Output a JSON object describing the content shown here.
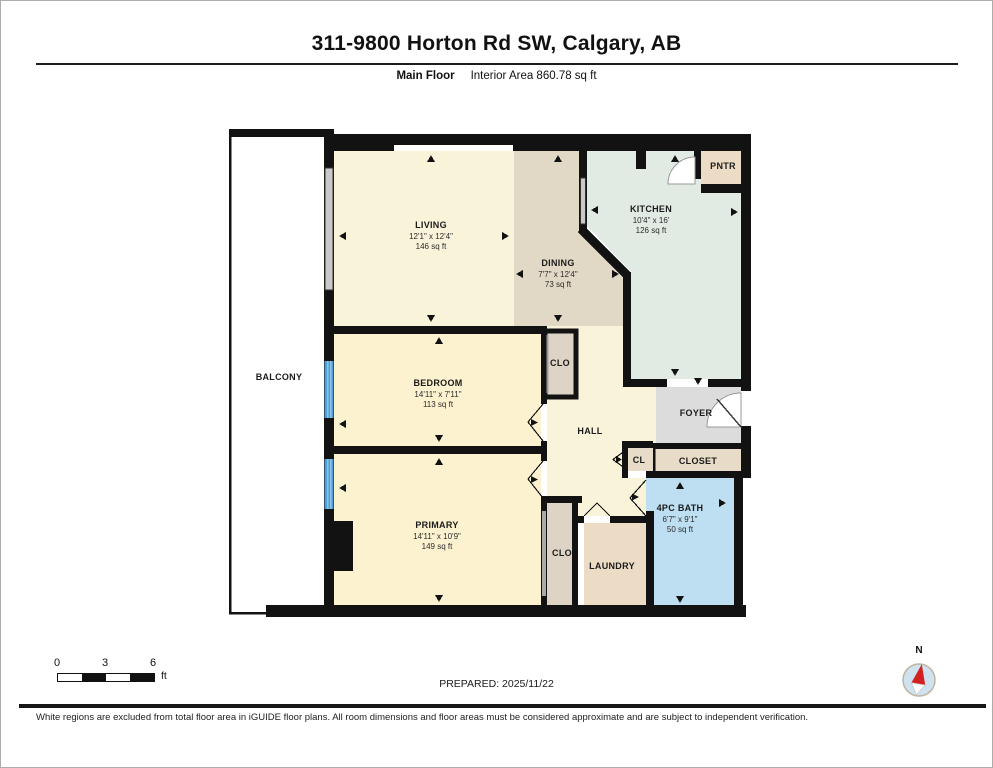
{
  "header": {
    "title": "311-9800 Horton Rd SW, Calgary, AB",
    "floor_label": "Main Floor",
    "area_label": "Interior Area 860.78 sq ft"
  },
  "rooms": {
    "balcony": {
      "name": "BALCONY"
    },
    "living": {
      "name": "LIVING",
      "dim": "12'1\" x 12'4\"",
      "area": "146 sq ft"
    },
    "dining": {
      "name": "DINING",
      "dim": "7'7\" x 12'4\"",
      "area": "73 sq ft"
    },
    "kitchen": {
      "name": "KITCHEN",
      "dim": "10'4\" x 16'",
      "area": "126 sq ft"
    },
    "pantry": {
      "name": "PNTR"
    },
    "bedroom": {
      "name": "BEDROOM",
      "dim": "14'11\" x 7'11\"",
      "area": "113 sq ft"
    },
    "bedroom_closet": {
      "name": "CLO"
    },
    "hall": {
      "name": "HALL"
    },
    "foyer": {
      "name": "FOYER"
    },
    "closet_small": {
      "name": "CL"
    },
    "closet": {
      "name": "CLOSET"
    },
    "primary": {
      "name": "PRIMARY",
      "dim": "14'11\" x 10'9\"",
      "area": "149 sq ft"
    },
    "primary_closet": {
      "name": "CLO"
    },
    "laundry": {
      "name": "LAUNDRY"
    },
    "bath": {
      "name": "4PC BATH",
      "dim": "6'7\" x 9'1\"",
      "area": "50 sq ft"
    }
  },
  "scale_bar": {
    "tick_0": "0",
    "tick_3": "3",
    "tick_6": "6",
    "unit": "ft"
  },
  "prepared": "PREPARED: 2025/11/22",
  "compass": {
    "north_label": "N"
  },
  "disclaimer": "White regions are excluded from total floor area in iGUIDE floor plans. All room dimensions and floor areas must be considered approximate and are subject to independent verification.",
  "colors": {
    "wall": "#121212",
    "living_cream": "#f8f3d9",
    "dining_tan": "#e2d8c6",
    "kitchen_green": "#e1ebe4",
    "pantry_tan": "#eddcc5",
    "bedroom_yellow": "#fcf2cf",
    "closet_gray": "#ddd4c6",
    "foyer_gray": "#dcdcdc",
    "bath_blue": "#bedef2",
    "window_gray": "#c9c9c9",
    "slider_blue": "#4d9fd6"
  }
}
